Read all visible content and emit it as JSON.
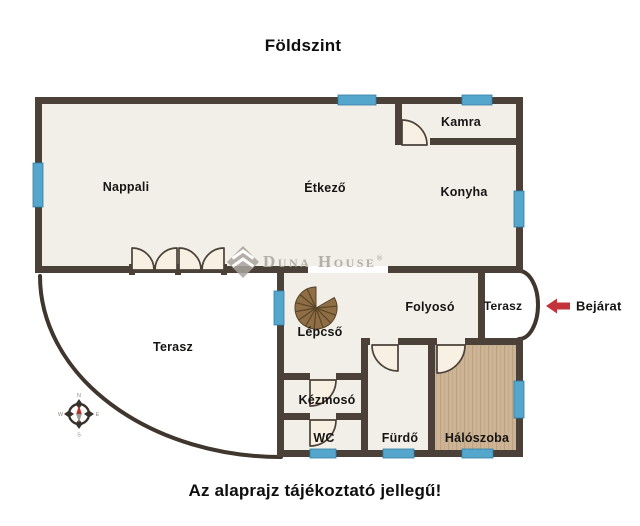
{
  "page": {
    "title": "Földszint",
    "disclaimer": "Az alaprajz tájékoztató jellegű!"
  },
  "watermark": {
    "brand": "Duna House",
    "registered": "®"
  },
  "entrance": {
    "label": "Bejárat"
  },
  "rooms": {
    "nappali": "Nappali",
    "etkezo": "Étkező",
    "konyha": "Konyha",
    "kamra": "Kamra",
    "folyoso": "Folyosó",
    "terasz_front": "Terasz",
    "lepcso": "Lépcső",
    "terasz_garden": "Terasz",
    "kezmoso": "Kézmosó",
    "wc": "WC",
    "furdo": "Fürdő",
    "haloszoba": "Hálószoba"
  },
  "compass": {
    "n": "N",
    "e": "E",
    "s": "S",
    "w": "W"
  },
  "colors": {
    "wall": "#4b4139",
    "window_blue": "#55a6cd",
    "floor": "#f2eee8",
    "wood_floor": "#cdb496",
    "entrance_arrow_red": "#c2343a",
    "watermark_gray": "#b2aea8"
  }
}
